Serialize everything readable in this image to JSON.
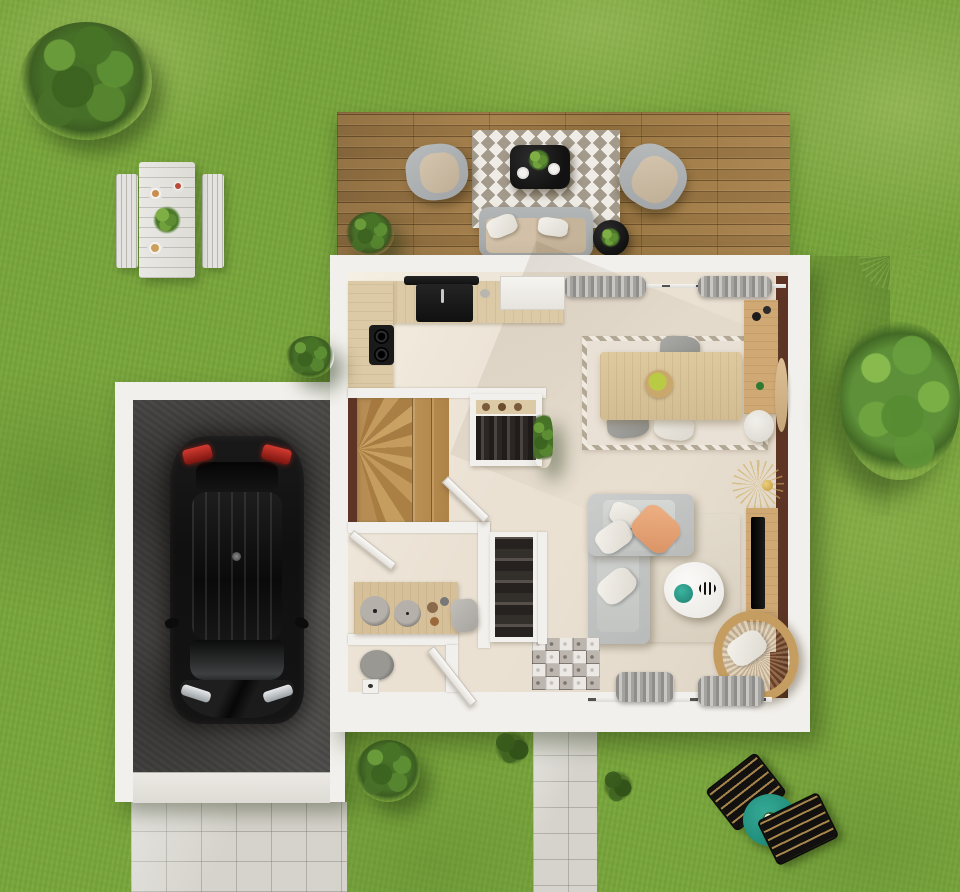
{
  "canvas": {
    "width": 960,
    "height": 892
  },
  "scene_type": "3d-top-down-house-floor-plan-render",
  "palette": {
    "grass": "#7aa63c",
    "grass_light": "#9dbb5f",
    "grass_dark": "#5c8a2e",
    "foliage": "#466f28",
    "tree": "#5d9038",
    "deck_a": "#9c7945",
    "wall": "#f2f0ec",
    "floor": "#eae1d3",
    "concrete": "#4d4b49",
    "pave": "#d6d3cc",
    "wood": "#dcc9a5",
    "wood_mid": "#cfa873",
    "stair": "#b78d54",
    "brown": "#5e3425",
    "rug_stripe": "#a39a8b",
    "teal": "#2aa18c",
    "rattan": "#c59d61",
    "tail_red": "#bf2320",
    "peach": "#e8a97e"
  },
  "outdoor": {
    "lawn": "textured grass",
    "deck": {
      "material": "wood planks",
      "furniture": [
        "armchair",
        "armchair",
        "chevron-rug",
        "black-coffee-table-with-plant",
        "outdoor-sofa-with-pillows",
        "round-side-table",
        "potted-plant"
      ]
    },
    "picnic_set": {
      "parts": [
        "white-plank-table",
        "bench-left",
        "bench-right",
        "plates",
        "centerpiece-plant"
      ]
    },
    "driveway": "light concrete pavers below garage",
    "walkway": "light concrete pavers below entry",
    "sun_loungers": {
      "count": 2,
      "style": "black with tan straps",
      "table": "round teal with small plant"
    },
    "vegetation": [
      "bush-top-left",
      "small-bush-left-of-house",
      "large-tree-right",
      "ornamental-grass-top-right",
      "shrub-bottom-center",
      "grass-tufts"
    ]
  },
  "garage": {
    "floor": "dark concrete",
    "contents": [
      "black car seen from above with red taillights"
    ]
  },
  "house": {
    "rooms": [
      "kitchen",
      "dining-area",
      "living-area",
      "staircase",
      "wardrobes",
      "bathroom",
      "wc",
      "entry"
    ],
    "kitchen": [
      "l-shaped-wood-counter",
      "black-range-hood",
      "black-range-with-sink",
      "two-burner-cooktop",
      "tall-white-cabinet"
    ],
    "dining": [
      "rectangular-wood-table",
      "fruit-bowl-centerpiece",
      "two-gray-chairs",
      "one-white-chair",
      "bordered-area-rug",
      "wall-sideboard",
      "round-white-pouf",
      "oval-standing-mirror",
      "gray-curtains-on-glazing"
    ],
    "living": [
      "l-shaped-gray-sofa",
      "white-pillows",
      "peach-pillow",
      "organic-white-coffee-table",
      "teal-plate",
      "striped-dish",
      "rattan-hanging-chair",
      "tv-console",
      "black-tv",
      "gold-wire-floor-lamp",
      "beige-area-rug",
      "gray-curtains-on-glazing"
    ],
    "staircase": "wood winder stairs with fan treads",
    "wardrobes": [
      "open-closet-with-clothes-upper",
      "open-closet-with-clothes-lower",
      "climbing-plant"
    ],
    "bathroom": [
      "wood-vanity",
      "two-round-vessel-sinks",
      "accessory-bowls",
      "gray-stool",
      "open-door"
    ],
    "wc": [
      "gray-toilet",
      "open-door"
    ],
    "entry": [
      "patterned-cement-tile-floor",
      "brown-front-door"
    ],
    "accents": [
      "dark-brown-wall-strip-right",
      "dark-brown-wall-strip-at-stairs"
    ]
  }
}
